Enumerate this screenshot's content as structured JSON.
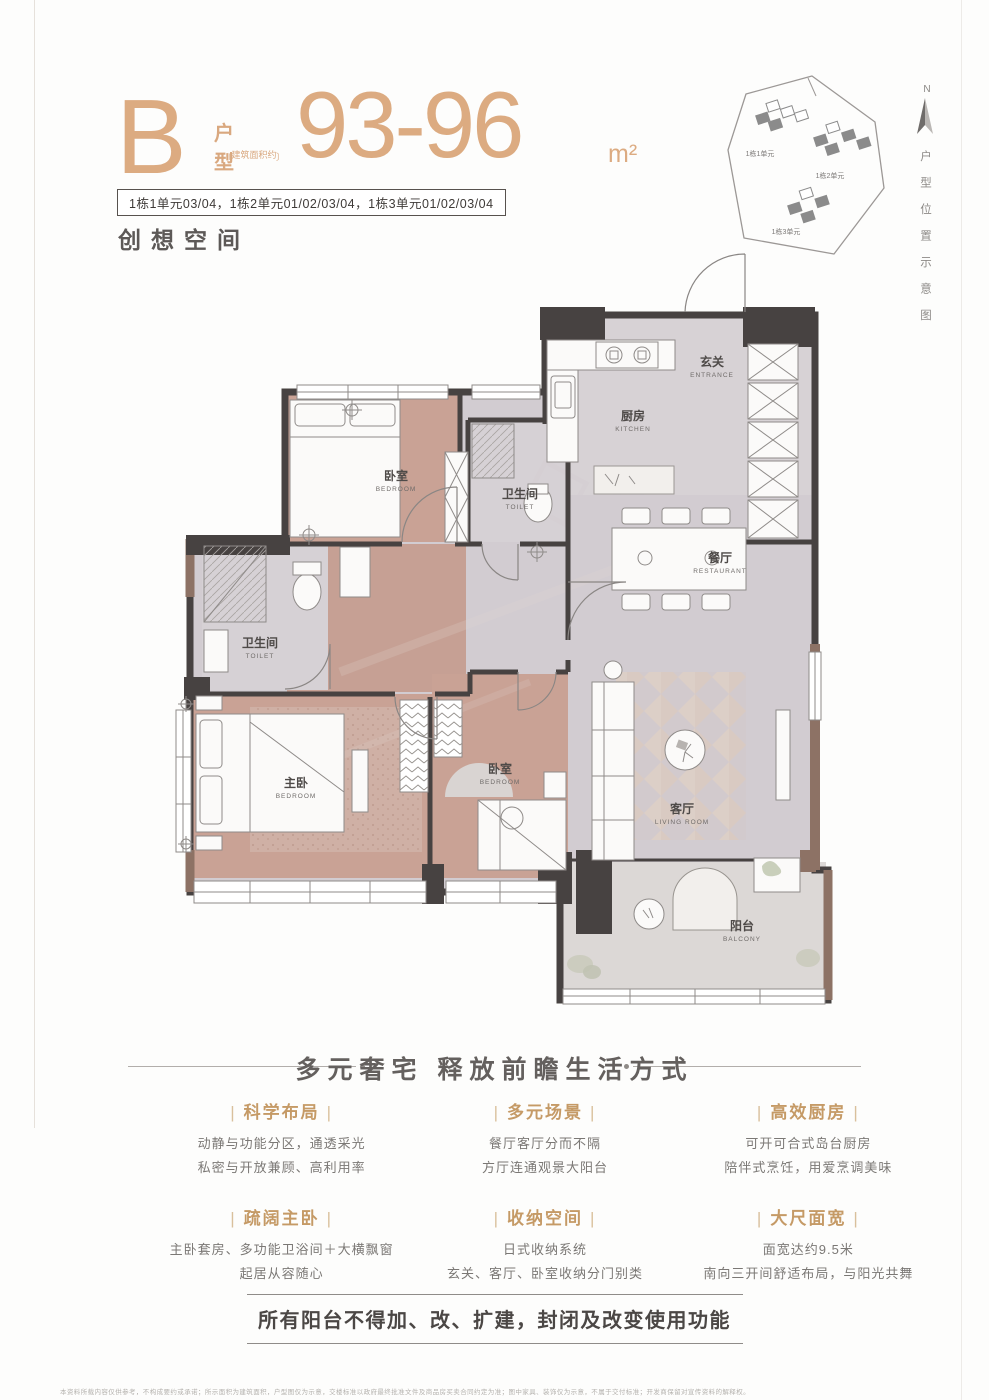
{
  "accent_color": "#dcab81",
  "header": {
    "type_letter": "B",
    "type_label": "户型",
    "area_note": "建筑面积约",
    "area_value": "93-96",
    "area_unit": "m²",
    "units_badge": "1栋1单元03/04，1栋2单元01/02/03/04，1栋3单元01/02/03/04",
    "tagline": "创想空间"
  },
  "site_map": {
    "north_label": "N",
    "caption_vertical": "户型位置示意图",
    "clusters": [
      "1栋1单元",
      "1栋2单元",
      "1栋3单元"
    ]
  },
  "floor_plan": {
    "rooms": [
      {
        "zh": "玄关",
        "en": "ENTRANCE"
      },
      {
        "zh": "厨房",
        "en": "KITCHEN"
      },
      {
        "zh": "卫生间",
        "en": "TOILET"
      },
      {
        "zh": "餐厅",
        "en": "RESTAURANT"
      },
      {
        "zh": "卧室",
        "en": "BEDROOM"
      },
      {
        "zh": "卫生间",
        "en": "TOILET"
      },
      {
        "zh": "主卧",
        "en": "BEDROOM"
      },
      {
        "zh": "卧室",
        "en": "BEDROOM"
      },
      {
        "zh": "客厅",
        "en": "LIVING ROOM"
      },
      {
        "zh": "阳台",
        "en": "BALCONY"
      }
    ]
  },
  "section": {
    "heading": "多元奢宅  释放前瞻生活方式",
    "features": [
      {
        "title": "科学布局",
        "lines": [
          "动静与功能分区，通透采光",
          "私密与开放兼顾、高利用率"
        ]
      },
      {
        "title": "多元场景",
        "lines": [
          "餐厅客厅分而不隔",
          "方厅连通观景大阳台"
        ]
      },
      {
        "title": "高效厨房",
        "lines": [
          "可开可合式岛台厨房",
          "陪伴式烹饪，用爱烹调美味"
        ]
      },
      {
        "title": "疏阔主卧",
        "lines": [
          "主卧套房、多功能卫浴间＋大横飘窗",
          "起居从容随心"
        ]
      },
      {
        "title": "收纳空间",
        "lines": [
          "日式收纳系统",
          "玄关、客厅、卧室收纳分门别类"
        ]
      },
      {
        "title": "大尺面宽",
        "lines": [
          "面宽达约9.5米",
          "南向三开间舒适布局，与阳光共舞"
        ]
      }
    ]
  },
  "footer": {
    "notice": "所有阳台不得加、改、扩建，封闭及改变使用功能",
    "disclaimer": "本资料所载内容仅供参考，不构成要约或承诺；所示面积为建筑面积，户型图仅为示意，交楼标准以政府最终批准文件及商品房买卖合同约定为准；图中家具、装饰仅为示意，不属于交付标准；开发商保留对宣传资料的解释权。"
  }
}
